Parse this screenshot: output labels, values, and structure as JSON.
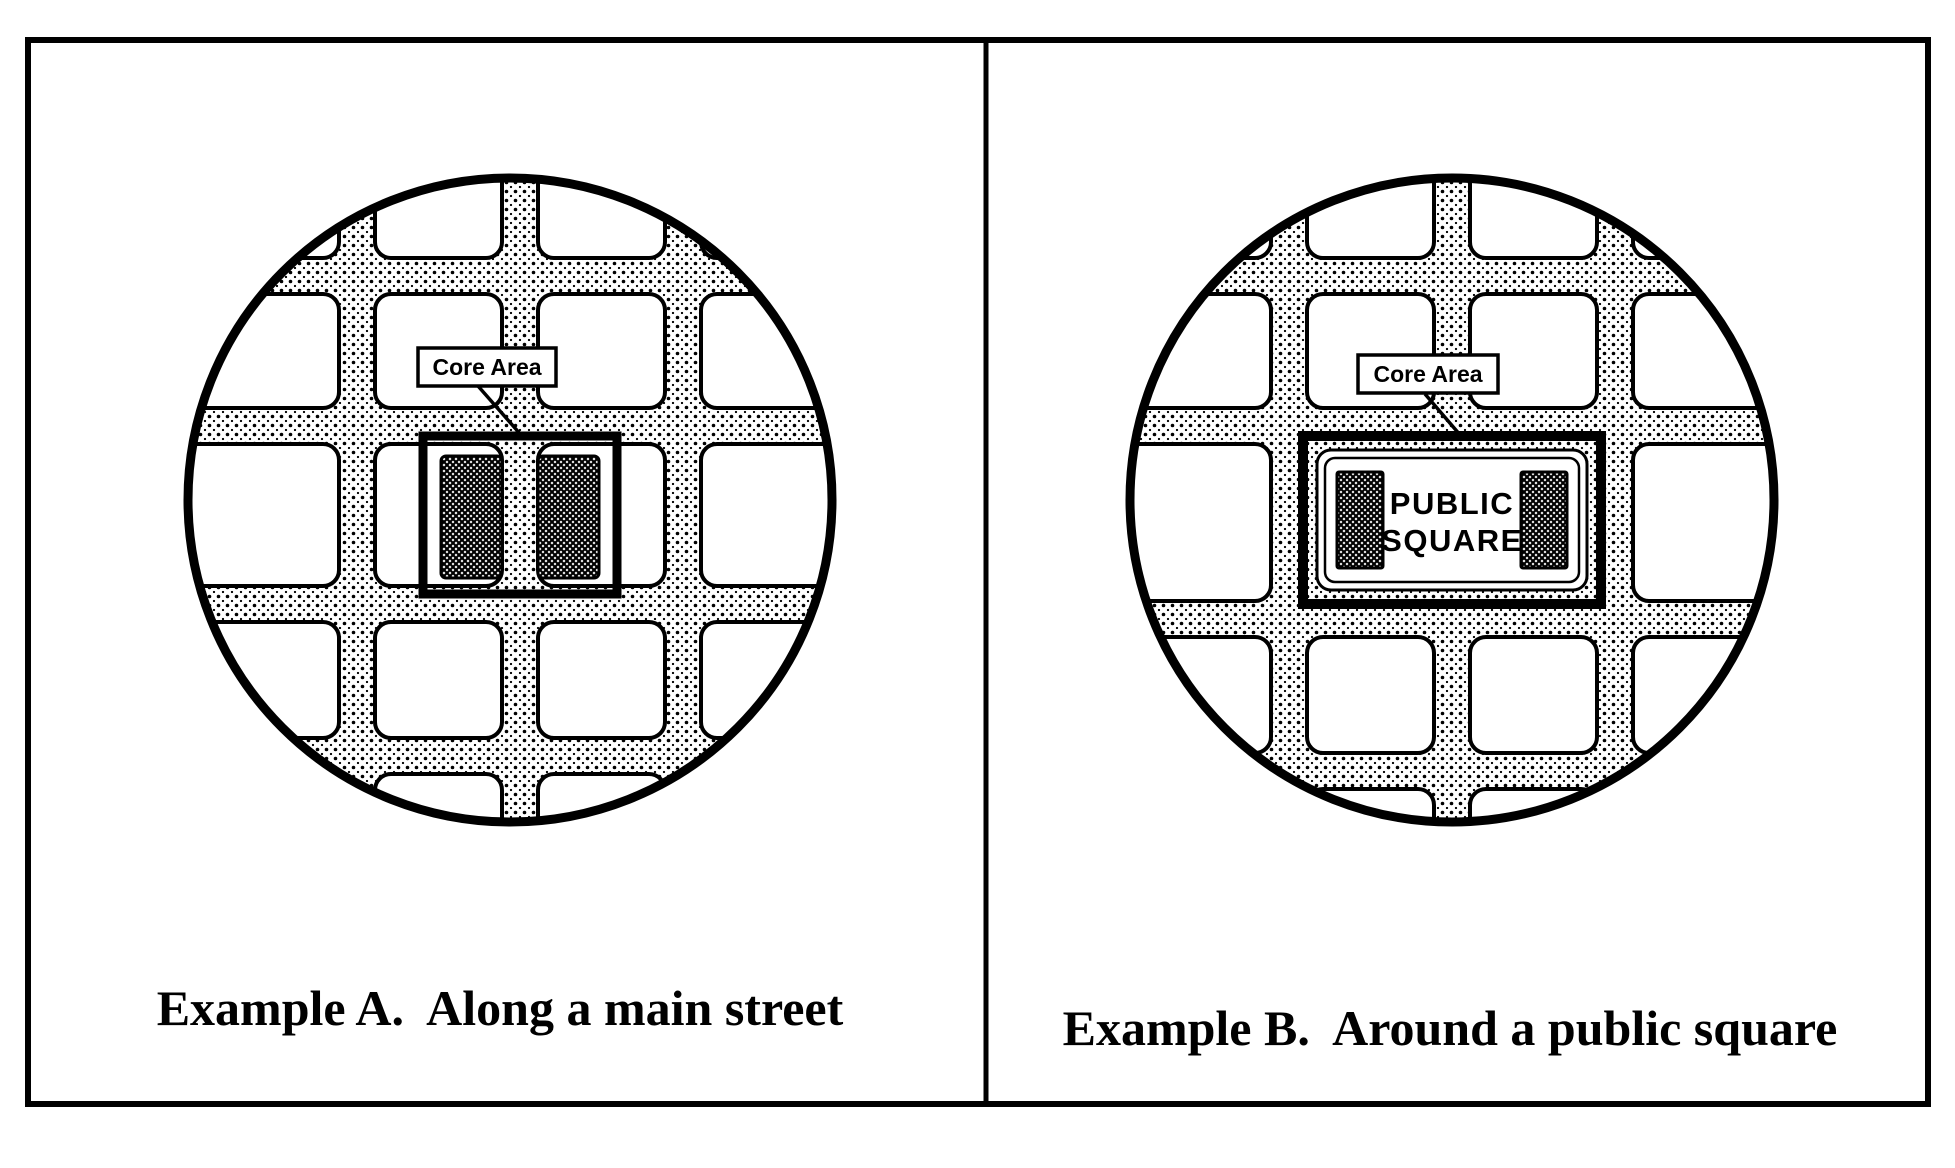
{
  "figure": {
    "colors": {
      "ink": "#000000",
      "paper": "#ffffff"
    },
    "panel_a": {
      "core_label": "Core Area",
      "caption": "Example A.  Along a main street"
    },
    "panel_b": {
      "core_label": "Core Area",
      "square_line1": "PUBLIC",
      "square_line2": "SQUARE",
      "caption": "Example B.  Around a public square"
    }
  }
}
